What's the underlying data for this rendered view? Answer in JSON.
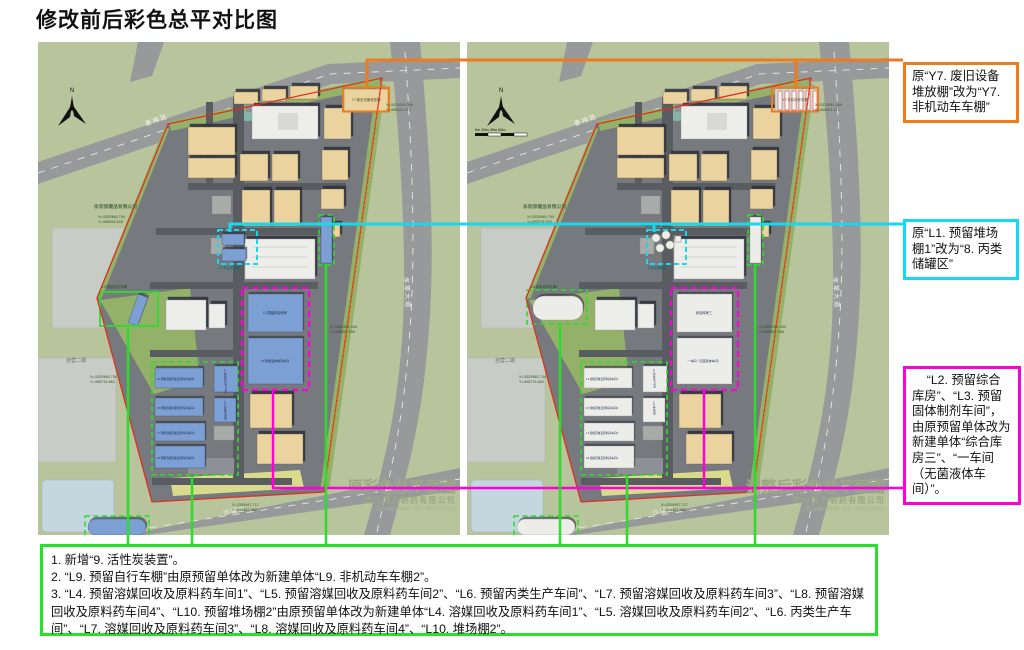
{
  "title": "修改前后彩色总平对比图",
  "colors": {
    "highlight_orange": "#EE7B1E",
    "highlight_cyan": "#17D8EC",
    "highlight_magenta": "#FF00DD",
    "highlight_green": "#2BDE2B",
    "boundary_red": "#E03020",
    "site_ground_green": "#B7C49C",
    "building_tan": "#EBD3A0",
    "reserved_building_blue": "#7C9FD4"
  },
  "shared": {
    "north": "N",
    "road_top": "春梅路",
    "road_right": "本草大道",
    "road_bottom": "沙堰街",
    "neighbor_company": "永欣保健品有限公司",
    "neighbor_area": "自营二期",
    "company": "四川国为制药有限公司",
    "project": "国为高端药物制剂一期及二期建设工程项目",
    "scale": "0m   20m   40m   60m",
    "coords": {
      "c1x": "X=3321051.349",
      "c1y": "Y=495021.271",
      "c2x": "X=3320965.794",
      "c2y": "Y=495024.543",
      "c3x": "X=3320965.734",
      "c3y": "Y=495713.862",
      "c4x": "X=3320951.494",
      "c4y": "Y=495857.456",
      "c5x": "X=3320947.717",
      "c5y": "Y=495867.387"
    }
  },
  "plans": {
    "left": {
      "title": "原彩色总平面图",
      "labels": {
        "y7": "Y7.废旧设备堆放棚",
        "l1": "L1.预留堆场棚1",
        "l2": "L2.预留综合库房",
        "l3": "L3.预留固体制剂车间",
        "l9": "L9.预留自行车棚",
        "l4": "L4.预留溶媒回收及原料药车间1",
        "l5": "L5.预留溶媒回收及原料药车间2",
        "l6": "L6.预留丙类生产车间",
        "l7": "L7.预留溶媒回收及原料药车间3",
        "l8": "L8.预留溶媒回收及原料药车间4",
        "l10": "L10.预留堆场棚2"
      }
    },
    "right": {
      "title": "调整后彩色总平面图",
      "labels": {
        "y7": "Y7.非机动车车棚",
        "l1": "8.丙类储罐区",
        "l2": "综合库房三",
        "l3": "一车间（无菌液体车间）",
        "l9": "L9.非机动车车棚2",
        "l4": "L4.溶媒回收及原料药车间1",
        "l5": "L5.溶媒回收及原料药车间2",
        "l6": "L6.丙类生产车间",
        "l7": "L7.溶媒回收及原料药车间3",
        "l8": "L8.溶媒回收及原料药车间4",
        "l10": "L10.堆场棚2",
        "n9": "9.活性炭装置"
      }
    }
  },
  "callouts": {
    "orange": {
      "text": "原“Y7. 废旧设备堆放棚”改为“Y7. 非机动车车棚”"
    },
    "cyan": {
      "text": "原“L1. 预留堆场棚1”改为“8. 丙类储罐区”"
    },
    "magenta": {
      "text": "“L2. 预留综合库房”、“L3. 预留固体制剂车间”，由原预留单体改为新建单体“综合库房三”、“一车间（无菌液体车间）”。"
    }
  },
  "notes": {
    "lines": [
      "1. 新增“9. 活性炭装置”。",
      "2. “L9. 预留自行车棚”由原预留单体改为新建单体“L9. 非机动车车棚2”。",
      "3. “L4. 预留溶媒回收及原料药车间1”、“L5. 预留溶媒回收及原料药车间2”、“L6. 预留丙类生产车间”、“L7. 预留溶媒回收及原料药车间3”、“L8. 预留溶媒回收及原料药车间4”、“L10. 预留堆场棚2”由原预留单体改为新建单体“L4. 溶媒回收及原料药车间1”、“L5. 溶媒回收及原料药车间2”、“L6. 丙类生产车间”、“L7. 溶媒回收及原料药车间3”、“L8. 溶媒回收及原料药车间4”、“L10. 堆场棚2”。"
    ]
  }
}
